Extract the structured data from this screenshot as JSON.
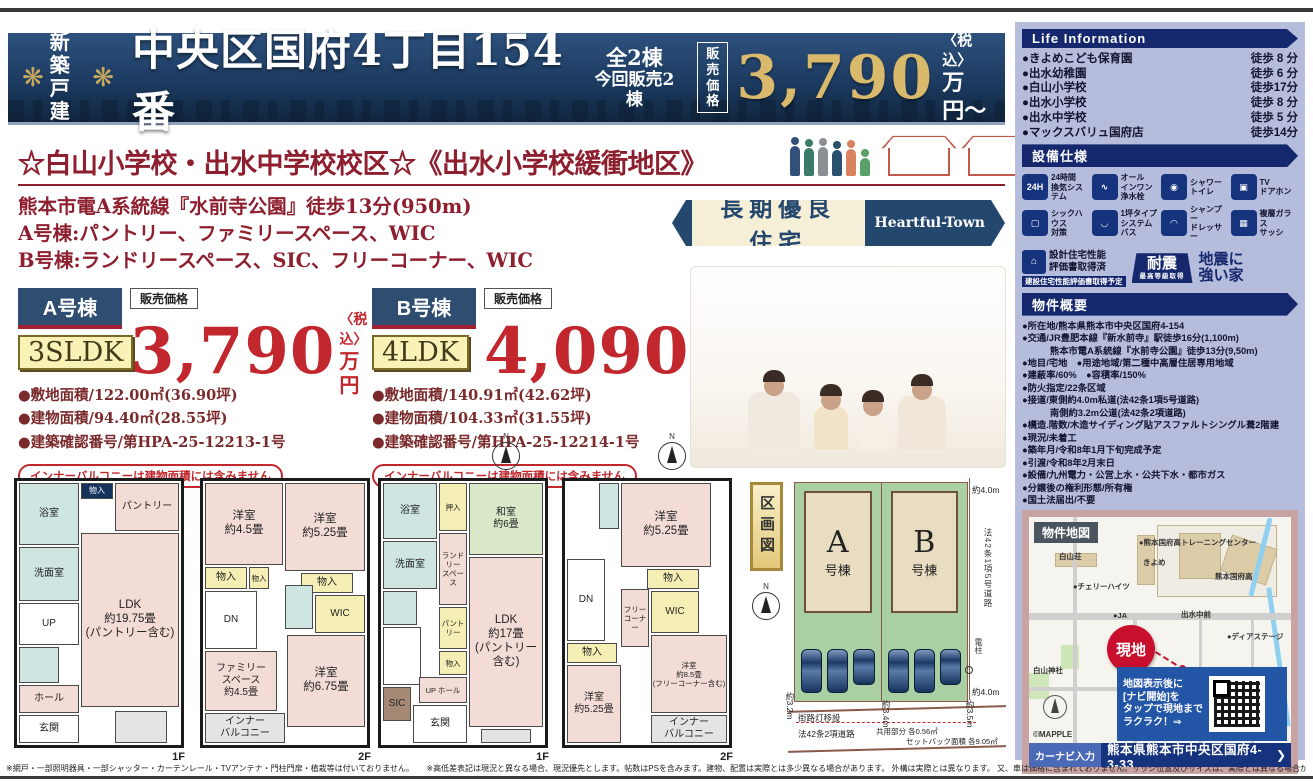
{
  "header": {
    "badge": "新築\n戸建",
    "title": "中央区国府4丁目154番",
    "units_total": "全2棟",
    "units_now": "今回販売2棟",
    "price_label": "販売\n価格",
    "price": "3,790",
    "tax": "〈税込〉",
    "unit": "万円〜"
  },
  "lead": {
    "headline": "☆白山小学校・出水中学校校区☆《出水小学校緩衝地区》",
    "line1": "熊本市電A系統線『水前寺公園』徒歩13分(950m)",
    "line2": "A号棟:パントリー、ファミリースペース、WIC",
    "line3": "B号棟:ランドリースペース、SIC、フリーコーナー、WIC",
    "cert_badge": "長期優良住宅",
    "brand": "Heartful-Town"
  },
  "units": [
    {
      "name": "A号棟",
      "layout": "3SLDK",
      "price_label": "販売価格",
      "price": "3,790",
      "tax": "〈税込〉",
      "unit": "万円",
      "spec1": "●敷地面積/122.00㎡(36.90坪)",
      "spec2": "●建物面積/94.40㎡(28.55坪)",
      "spec3": "●建築確認番号/第HPA-25-12213-1号",
      "note": "インナーバルコニーは建物面積には含みません"
    },
    {
      "name": "B号棟",
      "layout": "4LDK",
      "price_label": "販売価格",
      "price": "4,090",
      "tax": "〈税込〉",
      "unit": "万円",
      "spec1": "●敷地面積/140.91㎡(42.62坪)",
      "spec2": "●建物面積/104.33㎡(31.55坪)",
      "spec3": "●建築確認番号/第HPA-25-12214-1号",
      "note": "インナーバルコニーは建物面積には含みません"
    }
  ],
  "life_info": {
    "title": "Life Information",
    "items": [
      {
        "name": "●きよめこども保育園",
        "time": "徒歩 8 分"
      },
      {
        "name": "●出水幼稚園",
        "time": "徒歩 6 分"
      },
      {
        "name": "●白山小学校",
        "time": "徒歩17分"
      },
      {
        "name": "●出水小学校",
        "time": "徒歩 8 分"
      },
      {
        "name": "●出水中学校",
        "time": "徒歩 5 分"
      },
      {
        "name": "●マックスバリュ国府店",
        "time": "徒歩14分"
      }
    ]
  },
  "equipment": {
    "title": "設備仕様",
    "items": [
      {
        "icon": "ventilation-icon",
        "glyph": "24H",
        "label": "24時間\n換気システム"
      },
      {
        "icon": "faucet-icon",
        "glyph": "∿",
        "label": "オール\nインワン\n浄水栓"
      },
      {
        "icon": "shower-toilet-icon",
        "glyph": "◉",
        "label": "シャワー\nトイレ"
      },
      {
        "icon": "tv-doorphone-icon",
        "glyph": "▣",
        "label": "TV\nドアホン"
      },
      {
        "icon": "sick-house-icon",
        "glyph": "▢",
        "label": "シックハウス\n対策"
      },
      {
        "icon": "system-bath-icon",
        "glyph": "◡",
        "label": "1坪タイプ\nシステムバス"
      },
      {
        "icon": "shampoo-dresser-icon",
        "glyph": "◠",
        "label": "シャンプー\nドレッサー"
      },
      {
        "icon": "glass-sash-icon",
        "glyph": "▦",
        "label": "複層ガラス\nサッシ"
      }
    ]
  },
  "certs": {
    "design_line1": "設計住宅性能\n評価書取得済",
    "design_sub": "建設住宅性能評価書取得予定",
    "quake_badge": "耐震",
    "quake_badge_sub": "最高等級取得",
    "quake_text": "地震に\n強い家"
  },
  "overview": {
    "title": "物件概要",
    "items": [
      {
        "text": "●所在地/熊本県熊本市中央区国府4-154"
      },
      {
        "text": "●交通/JR豊肥本線『新水前寺』駅徒歩16分(1,100m)"
      },
      {
        "text": "　　　熊本市電A系統線『水前寺公園』徒歩13分(9,50m)"
      },
      {
        "text": "●地目/宅地　●用途地域/第二種中高層住居専用地域"
      },
      {
        "text": "●建蔽率/60%　●容積率/150%"
      },
      {
        "text": "●防火指定/22条区域"
      },
      {
        "text": "●接道/東側約4.0m私道(法42条1項5号道路)"
      },
      {
        "text": "　　　南側約3.2m公道(法42条2項道路)"
      },
      {
        "text": "●構造.階数/木造サイディング貼アスファルトシングル葺2階建"
      },
      {
        "text": "●現況/未着工"
      },
      {
        "text": "●築年月/令和8年1月下旬完成予定"
      },
      {
        "text": "●引渡/令和8年2月末日"
      },
      {
        "text": "●設備/九州電力・公営上水・公共下水・都市ガス"
      },
      {
        "text": "●分譲後の権利形態/所有権"
      },
      {
        "text": "●国土法届出/不要"
      }
    ]
  },
  "map": {
    "title": "物件地図",
    "genchi": "現地",
    "labels": [
      {
        "text": "白山荘",
        "x": 30,
        "y": 34
      },
      {
        "text": "●チェリーハイツ",
        "x": 44,
        "y": 64
      },
      {
        "text": "●熊本国府高トレーニングセンター",
        "x": 110,
        "y": 20
      },
      {
        "text": "きよめ",
        "x": 114,
        "y": 40
      },
      {
        "text": "熊本国府高",
        "x": 186,
        "y": 54
      },
      {
        "text": "●JA",
        "x": 84,
        "y": 94
      },
      {
        "text": "出水中前",
        "x": 152,
        "y": 92
      },
      {
        "text": "●ディアステージ",
        "x": 198,
        "y": 114
      },
      {
        "text": "白山神社",
        "x": 4,
        "y": 148
      },
      {
        "text": "国府4",
        "x": 122,
        "y": 162
      },
      {
        "text": "卍物吉寺",
        "x": 166,
        "y": 180
      }
    ],
    "qr_note": "地図表示後に\n[ナビ開始]を\nタップで現地まで\nラクラク！⇒",
    "nav_label": "カーナビ入力",
    "nav_address": "熊本県熊本市中央区国府4-3-33",
    "nav_arrow": "❯",
    "copyright": "©MAPPLE"
  },
  "siteplan": {
    "label": "区画図",
    "lot_a": "A",
    "lot_a_sub": "号棟",
    "lot_b": "B",
    "lot_b_sub": "号棟",
    "dim_top": "約4.0m",
    "road_right": "法42条1項5号道路",
    "dim_bottom": "約4.0m",
    "dim_left": "約3.2m",
    "streetlight": "街路灯移設",
    "road_bottom": "法42条2項道路",
    "common": "共用部分 各0.56㎡",
    "dim_34": "約3.4m",
    "setback": "セットバック面積 各9.05㎡",
    "dim_35": "約3.5m",
    "pole": "電柱"
  },
  "floorplans": [
    {
      "floor_label": "1F",
      "rooms": [
        {
          "label": "浴室",
          "x": 2,
          "y": 2,
          "w": 60,
          "h": 62,
          "bg": "#cfe5e2"
        },
        {
          "label": "物入",
          "x": 64,
          "y": 2,
          "w": 32,
          "h": 16,
          "bg": "#16335c",
          "cls": "darktag"
        },
        {
          "label": "パントリー",
          "x": 98,
          "y": 2,
          "w": 64,
          "h": 48,
          "bg": "#f3dbd6"
        },
        {
          "label": "洗面室",
          "x": 2,
          "y": 66,
          "w": 60,
          "h": 54,
          "bg": "#cfe5e2"
        },
        {
          "label": "UP",
          "x": 2,
          "y": 122,
          "w": 60,
          "h": 42,
          "bg": "#fff",
          "cls": "stairs"
        },
        {
          "label": "",
          "x": 2,
          "y": 166,
          "w": 40,
          "h": 36,
          "bg": "#cfe5e2"
        },
        {
          "label": "ホール",
          "x": 2,
          "y": 204,
          "w": 60,
          "h": 28,
          "bg": "#f3dbd6"
        },
        {
          "label": "玄関",
          "x": 2,
          "y": 234,
          "w": 60,
          "h": 28,
          "bg": "#ffffff"
        },
        {
          "label": "LDK\n約19.75畳\n(パントリー含む)",
          "x": 64,
          "y": 52,
          "w": 98,
          "h": 174,
          "bg": "#f3dbd6",
          "cls": "big"
        },
        {
          "label": "",
          "x": 98,
          "y": 230,
          "w": 52,
          "h": 32,
          "bg": "#e4e4e4"
        }
      ]
    },
    {
      "floor_label": "2F",
      "rooms": [
        {
          "label": "洋室\n約4.5畳",
          "x": 2,
          "y": 2,
          "w": 78,
          "h": 82,
          "bg": "#f3dbd6",
          "cls": "big"
        },
        {
          "label": "洋室\n約5.25畳",
          "x": 82,
          "y": 2,
          "w": 80,
          "h": 88,
          "bg": "#f3dbd6",
          "cls": "big"
        },
        {
          "label": "物入",
          "x": 2,
          "y": 86,
          "w": 42,
          "h": 22,
          "bg": "#f6efb5"
        },
        {
          "label": "物入",
          "x": 46,
          "y": 86,
          "w": 20,
          "h": 22,
          "bg": "#f6efb5",
          "cls": "tiny"
        },
        {
          "label": "物入",
          "x": 98,
          "y": 92,
          "w": 52,
          "h": 20,
          "bg": "#f6efb5"
        },
        {
          "label": "DN",
          "x": 2,
          "y": 110,
          "w": 52,
          "h": 58,
          "bg": "#fff",
          "cls": "stairs"
        },
        {
          "label": "",
          "x": 82,
          "y": 104,
          "w": 28,
          "h": 44,
          "bg": "#cfe5e2"
        },
        {
          "label": "WIC",
          "x": 112,
          "y": 114,
          "w": 50,
          "h": 38,
          "bg": "#f6efb5"
        },
        {
          "label": "ファミリー\nスペース\n約4.5畳",
          "x": 2,
          "y": 170,
          "w": 72,
          "h": 60,
          "bg": "#f3dbd6"
        },
        {
          "label": "洋室\n約6.75畳",
          "x": 84,
          "y": 154,
          "w": 78,
          "h": 92,
          "bg": "#f3dbd6",
          "cls": "big"
        },
        {
          "label": "インナー\nバルコニー",
          "x": 2,
          "y": 232,
          "w": 80,
          "h": 30,
          "bg": "#e4e4e4"
        }
      ]
    },
    {
      "floor_label": "1F",
      "rooms": [
        {
          "label": "浴室",
          "x": 2,
          "y": 2,
          "w": 54,
          "h": 56,
          "bg": "#cfe5e2"
        },
        {
          "label": "押入",
          "x": 58,
          "y": 2,
          "w": 28,
          "h": 48,
          "bg": "#f6efb5",
          "cls": "tiny"
        },
        {
          "label": "和室\n約6畳",
          "x": 88,
          "y": 2,
          "w": 74,
          "h": 72,
          "bg": "#d9e8c8"
        },
        {
          "label": "洗面室",
          "x": 2,
          "y": 60,
          "w": 54,
          "h": 48,
          "bg": "#cfe5e2"
        },
        {
          "label": "ランドリー\nスペース",
          "x": 58,
          "y": 52,
          "w": 28,
          "h": 72,
          "bg": "#f3dbd6",
          "cls": "tiny"
        },
        {
          "label": "パントリー",
          "x": 58,
          "y": 126,
          "w": 28,
          "h": 42,
          "bg": "#f6efb5",
          "cls": "tiny"
        },
        {
          "label": "",
          "x": 2,
          "y": 110,
          "w": 34,
          "h": 34,
          "bg": "#cfe5e2"
        },
        {
          "label": "",
          "x": 2,
          "y": 146,
          "w": 38,
          "h": 58,
          "bg": "#fff",
          "cls": "stairs"
        },
        {
          "label": "物入",
          "x": 58,
          "y": 170,
          "w": 28,
          "h": 24,
          "bg": "#f6efb5",
          "cls": "tiny"
        },
        {
          "label": "UP ホール",
          "x": 38,
          "y": 196,
          "w": 48,
          "h": 26,
          "bg": "#f3dbd6",
          "cls": "tiny"
        },
        {
          "label": "SIC",
          "x": 2,
          "y": 206,
          "w": 28,
          "h": 34,
          "bg": "#a58974"
        },
        {
          "label": "玄関",
          "x": 32,
          "y": 224,
          "w": 54,
          "h": 38,
          "bg": "#ffffff"
        },
        {
          "label": "LDK\n約17畳\n(パントリー含む)",
          "x": 88,
          "y": 76,
          "w": 74,
          "h": 170,
          "bg": "#f3dbd6",
          "cls": "big"
        },
        {
          "label": "",
          "x": 100,
          "y": 248,
          "w": 50,
          "h": 14,
          "bg": "#e4e4e4"
        }
      ]
    },
    {
      "floor_label": "2F",
      "rooms": [
        {
          "label": "洋室\n約5.25畳",
          "x": 56,
          "y": 2,
          "w": 90,
          "h": 84,
          "bg": "#f3dbd6",
          "cls": "big"
        },
        {
          "label": "",
          "x": 34,
          "y": 2,
          "w": 20,
          "h": 46,
          "bg": "#cfe5e2"
        },
        {
          "label": "DN",
          "x": 2,
          "y": 78,
          "w": 38,
          "h": 82,
          "bg": "#fff",
          "cls": "stairs"
        },
        {
          "label": "物入",
          "x": 82,
          "y": 88,
          "w": 52,
          "h": 20,
          "bg": "#f6efb5"
        },
        {
          "label": "フリー\nコーナー",
          "x": 56,
          "y": 108,
          "w": 28,
          "h": 58,
          "bg": "#f3dbd6",
          "cls": "tiny"
        },
        {
          "label": "WIC",
          "x": 86,
          "y": 110,
          "w": 48,
          "h": 42,
          "bg": "#f6efb5"
        },
        {
          "label": "洋室\n約8.5畳\n(フリーコーナー含む)",
          "x": 86,
          "y": 154,
          "w": 76,
          "h": 78,
          "bg": "#f3dbd6",
          "cls": "tiny"
        },
        {
          "label": "物入",
          "x": 2,
          "y": 162,
          "w": 50,
          "h": 20,
          "bg": "#f6efb5"
        },
        {
          "label": "洋室\n約5.25畳",
          "x": 2,
          "y": 184,
          "w": 54,
          "h": 78,
          "bg": "#f3dbd6"
        },
        {
          "label": "インナー\nバルコニー",
          "x": 86,
          "y": 234,
          "w": 76,
          "h": 28,
          "bg": "#e4e4e4"
        }
      ]
    }
  ],
  "footer": {
    "note1": "※網戸・一部照明器具・一部シャッター・カーテンレール・TVアンテナ・門柱門扉・植栽等は付いておりません。",
    "note2": "※高低差表記は現況と異なる場合、現況優先とします。帖数はPSを含みます。建物、配置は実際とは多少異なる場合があります。 外構は実際とは異なります。 又、車は価格に含まれておりません。サッシ位置及びサイズは、実際とは異なる場合があります。図面と現況が異なる場合は現況優先とします。"
  }
}
